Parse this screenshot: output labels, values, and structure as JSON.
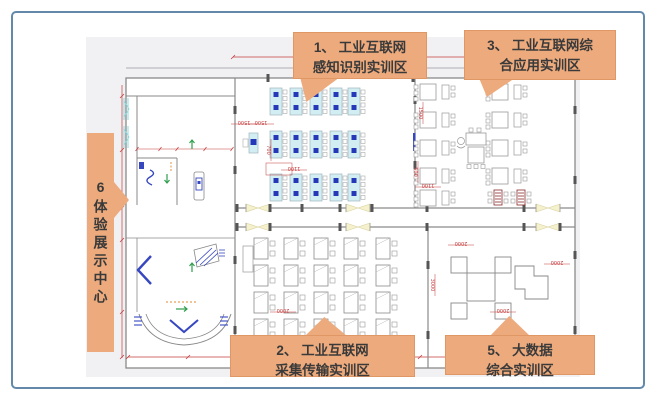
{
  "frame": {
    "border_color": "#6289aa",
    "bg": "#ffffff"
  },
  "callout_style": {
    "fill": "#ecaa7d",
    "border": "#de9765",
    "text_color": "#3a3a3a"
  },
  "callouts": {
    "zone1": {
      "line1": "1、 工业互联网",
      "line2": "感知识别实训区"
    },
    "zone2": {
      "line1": "2、 工业互联网",
      "line2": "采集传输实训区"
    },
    "zone3": {
      "line1": "3、 工业互联网综",
      "line2": "合应用实训区"
    },
    "zone5": {
      "line1": "5、 大数据",
      "line2": "综合实训区"
    },
    "zone6": {
      "text": "6体验展示中心"
    }
  },
  "plan": {
    "bg": "#f1f1f4",
    "room_fill": "#ffffff",
    "wall_color": "#8a8a8a",
    "dim_color": "#c43c3c",
    "desk_fill": "#d3eef2",
    "desk_dot": "#2438b8",
    "door_fill": "#f6f1cd",
    "door_edge": "#d8d2a0",
    "accent_green": "#2f9e4e",
    "accent_blue": "#3747c0",
    "accent_orange": "#e08a2e",
    "accent_maroon": "#8a2a2a",
    "window_cyan": "#8fd8dc",
    "zones": {
      "zone1_workstations": {
        "cols": 5,
        "row_groups": 3,
        "stations_per_group": 2
      },
      "zone2_desks": {
        "cols": 5,
        "rows": 4
      },
      "zone3_tables": {
        "cols": 2,
        "rows": 5
      },
      "zone5_cluster": {
        "corner_tables": 4,
        "center_tables": 1
      }
    },
    "dim_labels": [
      {
        "text": "1500",
        "x": 244,
        "y": 121,
        "rot": 180
      },
      {
        "text": "1500",
        "x": 261,
        "y": 121,
        "rot": 180
      },
      {
        "text": "700",
        "x": 267,
        "y": 150,
        "rot": 90
      },
      {
        "text": "1100",
        "x": 294,
        "y": 167,
        "rot": 180
      },
      {
        "text": "2000",
        "x": 283,
        "y": 309,
        "rot": 180
      },
      {
        "text": "1500",
        "x": 419,
        "y": 113,
        "rot": 90
      },
      {
        "text": "500",
        "x": 414,
        "y": 172,
        "rot": 90
      },
      {
        "text": "1100",
        "x": 428,
        "y": 184,
        "rot": 180
      },
      {
        "text": "2000",
        "x": 461,
        "y": 242,
        "rot": 180
      },
      {
        "text": "2000",
        "x": 557,
        "y": 261,
        "rot": 180
      },
      {
        "text": "3000",
        "x": 431,
        "y": 285,
        "rot": 90
      },
      {
        "text": "2000",
        "x": 503,
        "y": 309,
        "rot": 180
      }
    ]
  }
}
